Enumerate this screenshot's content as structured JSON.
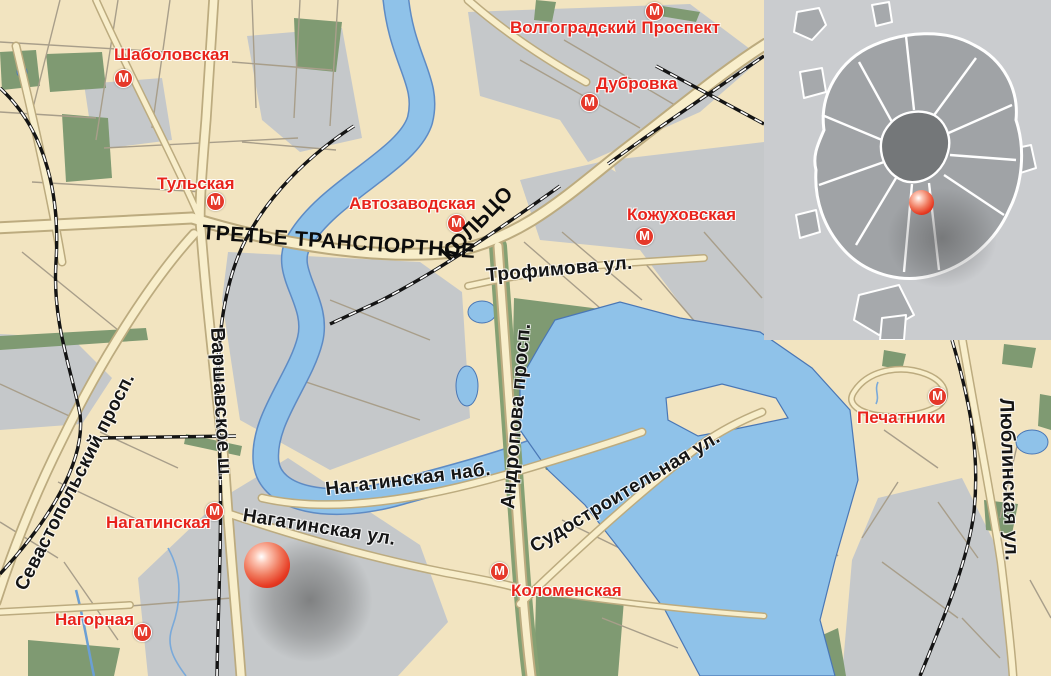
{
  "map": {
    "metro_glyph": "М",
    "ring_road": {
      "line1": "ТРЕТЬЕ ТРАНСПОРТНОЕ",
      "line2": "КОЛЬЦО"
    },
    "stations": [
      {
        "name": "Шаболовская"
      },
      {
        "name": "Тульская"
      },
      {
        "name": "Автозаводская"
      },
      {
        "name": "Волгоградский Проспект"
      },
      {
        "name": "Дубровка"
      },
      {
        "name": "Кожуховская"
      },
      {
        "name": "Нагатинская"
      },
      {
        "name": "Нагорная"
      },
      {
        "name": "Коломенская"
      },
      {
        "name": "Печатники"
      }
    ],
    "streets": [
      {
        "name": "Севастопольский просп."
      },
      {
        "name": "Варшавское ш."
      },
      {
        "name": "Андропова просп."
      },
      {
        "name": "Люблинская ул."
      },
      {
        "name": "Нагатинская наб."
      },
      {
        "name": "Нагатинская ул."
      },
      {
        "name": "Трофимова ул."
      },
      {
        "name": "Судостроительная ул."
      }
    ],
    "colors": {
      "land": "#f2e4c0",
      "industrial": "#c5c8ca",
      "park": "#7f9a72",
      "water": "#8fc2e9",
      "road_fill": "#f8eecb",
      "road_casing": "#bcab7f",
      "railroad": "#141414",
      "station_label": "#e8231b",
      "street_label": "#151515",
      "metro_icon": "#e5382a",
      "marker": "#e63a22",
      "inset_background": "#cacccf",
      "inset_city": "#a0a3a6",
      "inset_center": "#747779"
    }
  }
}
